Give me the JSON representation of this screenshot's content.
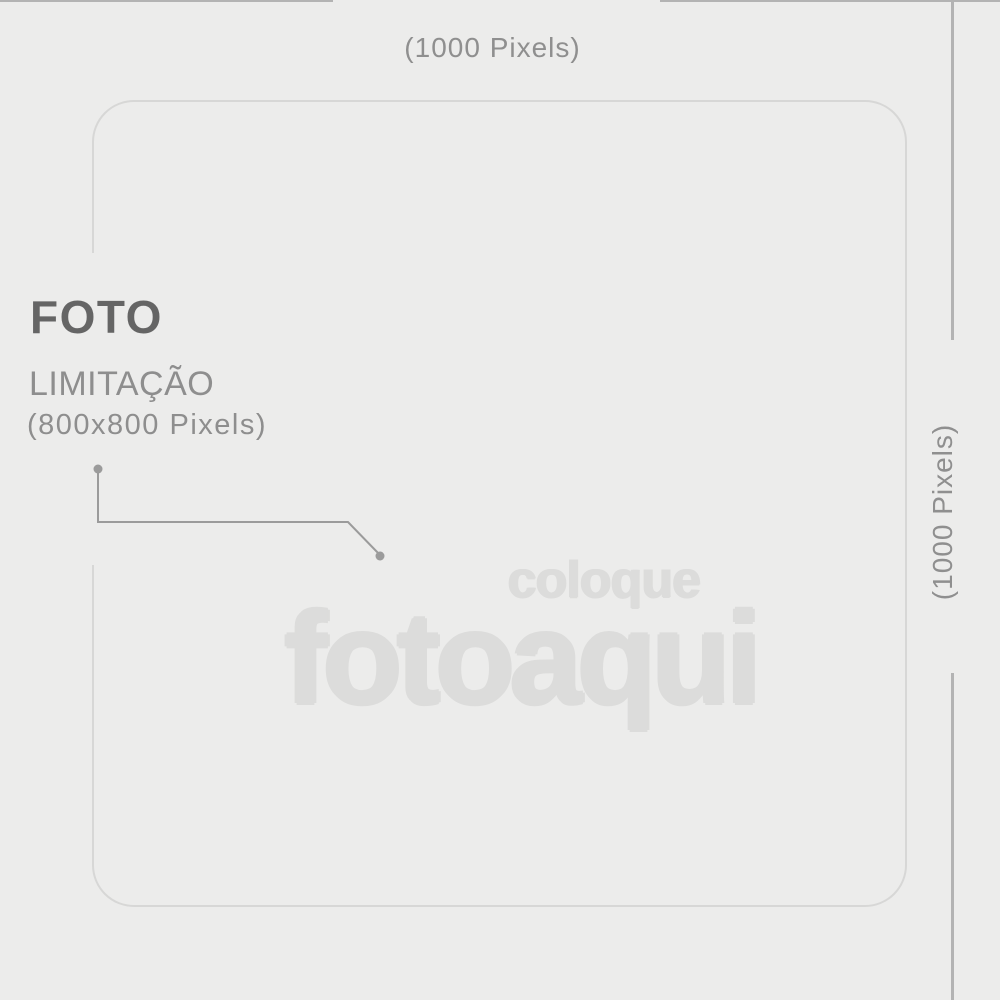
{
  "colors": {
    "bg": "#ececeb",
    "dim-line": "#b3b3b3",
    "dim-text": "#8f8f8f",
    "box-border": "#d7d7d6",
    "title-text": "#656565",
    "secondary-text": "#8e8e8e",
    "connector": "#9b9b9b",
    "watermark": "#dcdcdb"
  },
  "dimension_labels": {
    "top": "(1000 Pixels)",
    "right": "(1000 Pixels)"
  },
  "photo_note": {
    "title": "FOTO",
    "subtitle": "LIMITAÇÃO",
    "size": "(800x800 Pixels)"
  },
  "watermark": {
    "word1": "coloque",
    "word2": "fotoaqui"
  }
}
